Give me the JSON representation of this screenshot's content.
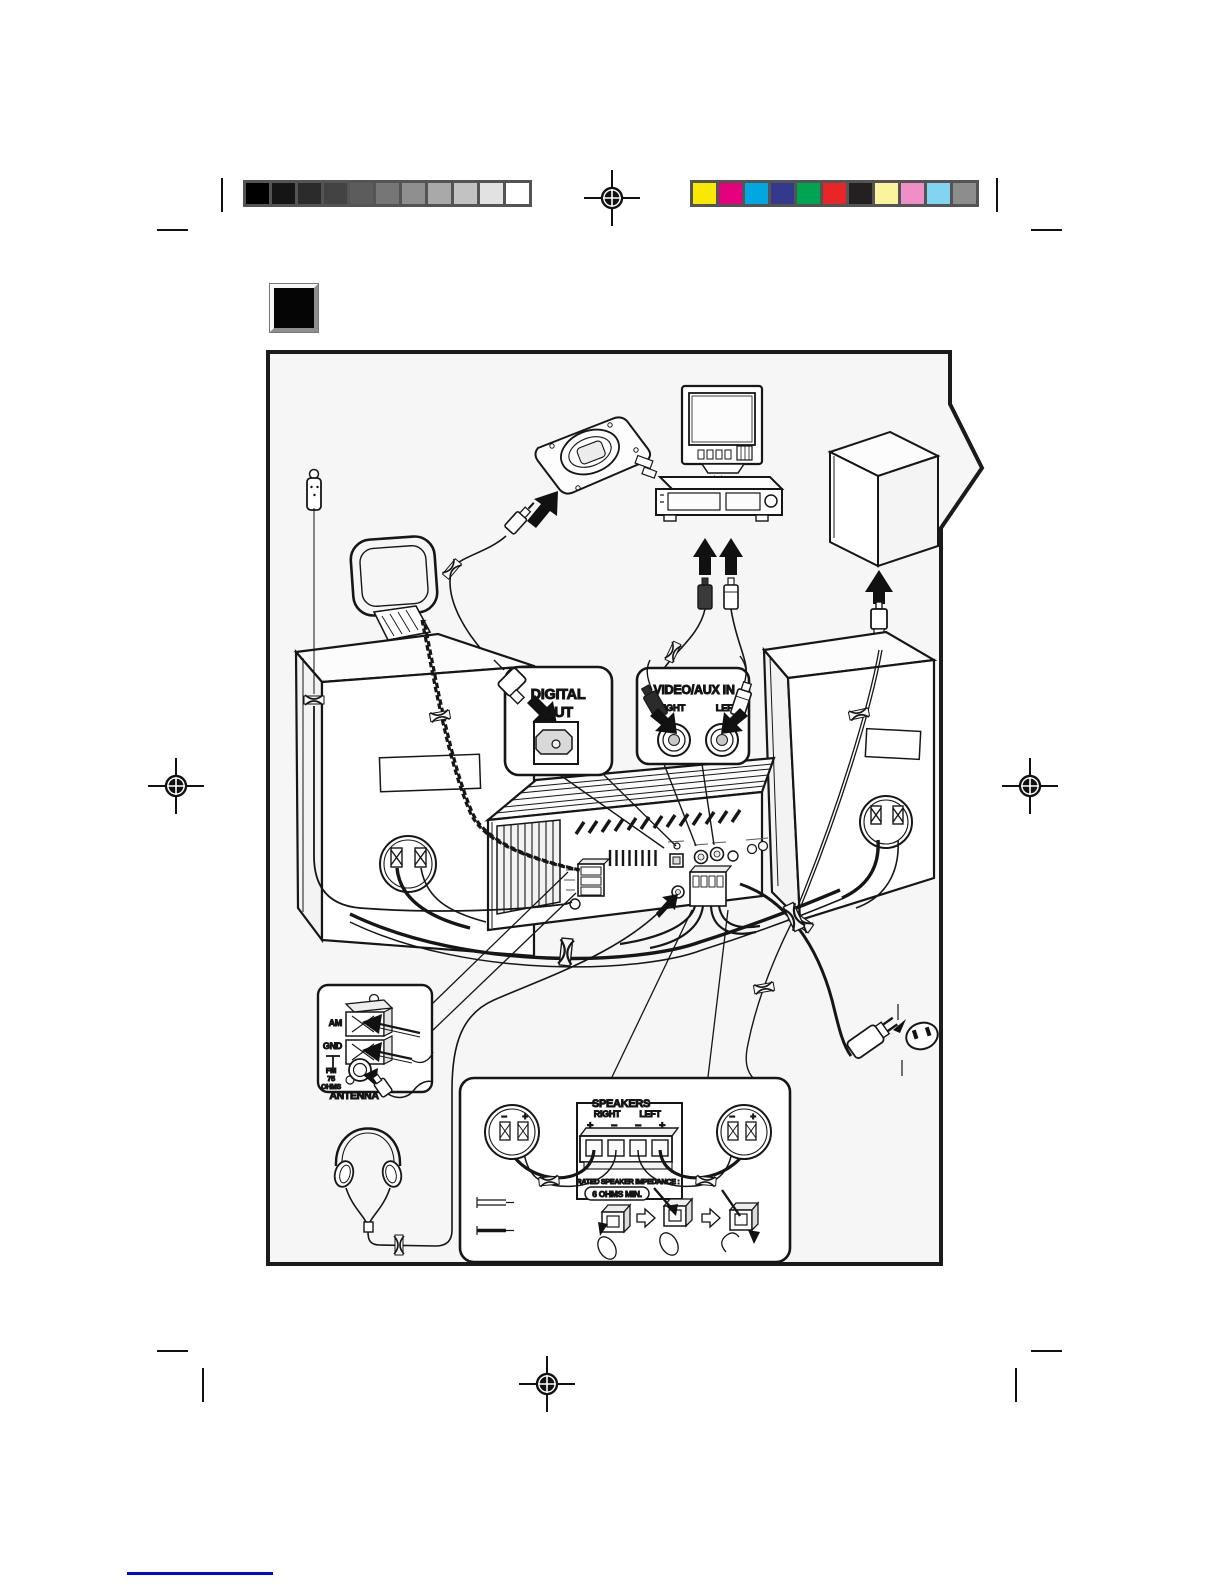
{
  "calibration": {
    "grayscale": [
      "#000000",
      "#151515",
      "#2b2b2b",
      "#434343",
      "#5c5c5c",
      "#767676",
      "#8f8f8f",
      "#a9a9a9",
      "#c2c2c2",
      "#e2e2e2",
      "#ffffff"
    ],
    "colors": [
      "#f9e800",
      "#e5007e",
      "#00a7e1",
      "#333a8e",
      "#00a551",
      "#e92528",
      "#241f20",
      "#fbf49c",
      "#f08fc7",
      "#82d4f1",
      "#8d8d8d"
    ]
  },
  "callouts": {
    "digital_out": {
      "line1": "DIGITAL",
      "line2": "OUT"
    },
    "video_aux": {
      "title": "VIDEO/AUX IN",
      "right": "RIGHT",
      "left": "LEFT"
    },
    "antenna": {
      "am": "AM",
      "gnd": "GND",
      "fm": "FM",
      "ohms_value": "75",
      "ohms_unit": "OHMS",
      "title": "ANTENNA"
    },
    "speakers": {
      "title": "SPEAKERS",
      "right": "RIGHT",
      "left": "LEFT",
      "pol": [
        "+",
        "−",
        "−",
        "+"
      ],
      "cup_minus": "−",
      "cup_plus": "+",
      "impedance": "RATED SPEAKER IMPEDANCE :",
      "impedance_value": "6  OHMS MIN."
    }
  }
}
